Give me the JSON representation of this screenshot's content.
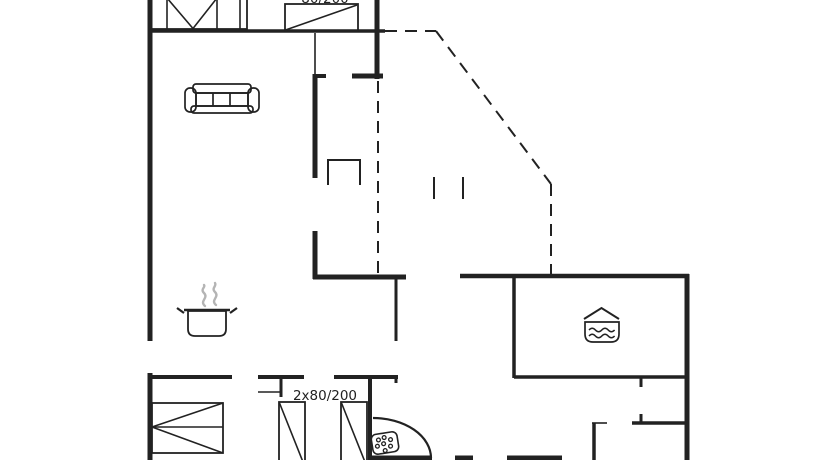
{
  "plan": {
    "width": 834,
    "height": 460,
    "line_color": "#222222",
    "steam_color": "#b4b4b4",
    "background": "#ffffff",
    "walls": [
      {
        "w": 5,
        "x1": 150,
        "y1": -2,
        "x2": 150,
        "y2": 341
      },
      {
        "w": 5,
        "x1": 150,
        "y1": 373,
        "x2": 150,
        "y2": 460
      },
      {
        "w": 5,
        "x1": 377,
        "y1": -2,
        "x2": 377,
        "y2": 79
      },
      {
        "w": 5,
        "x1": 352,
        "y1": 76,
        "x2": 383,
        "y2": 76
      },
      {
        "w": 4,
        "x1": 313,
        "y1": 76,
        "x2": 326,
        "y2": 76
      },
      {
        "w": 5,
        "x1": 315,
        "y1": 74,
        "x2": 315,
        "y2": 178
      },
      {
        "w": 5,
        "x1": 315,
        "y1": 231,
        "x2": 315,
        "y2": 279
      },
      {
        "w": 5,
        "x1": 313,
        "y1": 277,
        "x2": 406,
        "y2": 277
      },
      {
        "w": 4.5,
        "x1": 460,
        "y1": 276,
        "x2": 689,
        "y2": 276
      },
      {
        "w": 5,
        "x1": 687,
        "y1": 274,
        "x2": 687,
        "y2": 460
      },
      {
        "w": 3.5,
        "x1": 148,
        "y1": 31,
        "x2": 385,
        "y2": 31
      },
      {
        "w": 3,
        "x1": 396,
        "y1": 277,
        "x2": 396,
        "y2": 341
      },
      {
        "w": 3.5,
        "x1": 514,
        "y1": 276,
        "x2": 514,
        "y2": 378
      },
      {
        "w": 3.5,
        "x1": 514,
        "y1": 377,
        "x2": 687,
        "y2": 377
      },
      {
        "w": 3,
        "x1": 641,
        "y1": 377,
        "x2": 641,
        "y2": 387
      },
      {
        "w": 3,
        "x1": 641,
        "y1": 414,
        "x2": 641,
        "y2": 424
      },
      {
        "w": 3.5,
        "x1": 632,
        "y1": 423,
        "x2": 688,
        "y2": 423
      },
      {
        "w": 3.5,
        "x1": 594,
        "y1": 423,
        "x2": 594,
        "y2": 460
      },
      {
        "w": 4,
        "x1": 148,
        "y1": 377,
        "x2": 232,
        "y2": 377
      },
      {
        "w": 4,
        "x1": 258,
        "y1": 377,
        "x2": 304,
        "y2": 377
      },
      {
        "w": 4,
        "x1": 334,
        "y1": 377,
        "x2": 398,
        "y2": 377
      },
      {
        "w": 3,
        "x1": 281,
        "y1": 377,
        "x2": 281,
        "y2": 397
      },
      {
        "w": 3,
        "x1": 396,
        "y1": 377,
        "x2": 396,
        "y2": 383
      },
      {
        "w": 4,
        "x1": 370,
        "y1": 377,
        "x2": 370,
        "y2": 460
      },
      {
        "w": 5,
        "x1": 370,
        "y1": 458,
        "x2": 432,
        "y2": 458
      },
      {
        "w": 5,
        "x1": 455,
        "y1": 458,
        "x2": 473,
        "y2": 458
      },
      {
        "w": 5,
        "x1": 507,
        "y1": 458,
        "x2": 562,
        "y2": 458
      }
    ],
    "thin_lines": [
      {
        "name": "thin-wall-line",
        "w": 1.6,
        "x1": 315,
        "y1": 33,
        "x2": 315,
        "y2": 74
      },
      {
        "name": "thin-wall-line",
        "w": 1.6,
        "x1": 258,
        "y1": 392,
        "x2": 281,
        "y2": 392
      },
      {
        "name": "door-frame-line",
        "w": 1.6,
        "x1": 592,
        "y1": 423,
        "x2": 607,
        "y2": 423
      },
      {
        "name": "terrace-post-mark",
        "w": 2,
        "x1": 434,
        "y1": 177,
        "x2": 434,
        "y2": 199
      },
      {
        "name": "terrace-post-mark",
        "w": 2,
        "x1": 463,
        "y1": 177,
        "x2": 463,
        "y2": 199
      }
    ],
    "dashed_lines": [
      {
        "w": 2,
        "x1": 385,
        "y1": 31,
        "x2": 436,
        "y2": 31
      },
      {
        "w": 2,
        "x1": 436,
        "y1": 31,
        "x2": 551,
        "y2": 184
      },
      {
        "w": 2,
        "x1": 551,
        "y1": 184,
        "x2": 551,
        "y2": 276
      },
      {
        "w": 2,
        "x1": 378,
        "y1": 81,
        "x2": 378,
        "y2": 276
      }
    ],
    "texts": [
      {
        "name": "bunk-beds-size-label",
        "text": "2x80/200",
        "x": 325,
        "y": 400,
        "size": 13.5
      },
      {
        "name": "double-bed-size-label",
        "text": "180/200",
        "x": 207,
        "y": 470,
        "size": 13.5
      },
      {
        "name": "top-bed-size-label",
        "text": "80/200",
        "x": 325,
        "y": 3,
        "size": 13.5
      }
    ],
    "furniture": [
      {
        "name": "wardrobe-icon",
        "shapes": [
          {
            "t": "rect",
            "x": 150,
            "y": -4,
            "w": 97,
            "h": 33,
            "sw": 1.8
          },
          {
            "t": "line",
            "x1": 167,
            "y1": -2,
            "x2": 167,
            "y2": 29,
            "sw": 1.6
          },
          {
            "t": "line",
            "x1": 217,
            "y1": -2,
            "x2": 217,
            "y2": 29,
            "sw": 1.6
          },
          {
            "t": "line",
            "x1": 240,
            "y1": -2,
            "x2": 240,
            "y2": 29,
            "sw": 1.6
          },
          {
            "t": "poly",
            "pts": "167,-2 193,28.5 217,-2",
            "sw": 1.6
          }
        ]
      },
      {
        "name": "single-bed-icon",
        "shapes": [
          {
            "t": "rect",
            "x": 285,
            "y": 4,
            "w": 73,
            "h": 27,
            "sw": 1.8
          },
          {
            "t": "line",
            "x1": 285.5,
            "y1": 30,
            "x2": 357,
            "y2": 5,
            "sw": 1.6
          }
        ]
      },
      {
        "name": "sofa-icon",
        "shapes": [
          {
            "t": "rect",
            "x": 193,
            "y": 84,
            "w": 58,
            "h": 9,
            "rx": 3,
            "sw": 1.7
          },
          {
            "t": "rect",
            "x": 185,
            "y": 88,
            "w": 11,
            "h": 24,
            "rx": 5,
            "sw": 1.7
          },
          {
            "t": "rect",
            "x": 248,
            "y": 88,
            "w": 11,
            "h": 24,
            "rx": 5,
            "sw": 1.7
          },
          {
            "t": "rect",
            "x": 196,
            "y": 93,
            "w": 52,
            "h": 13,
            "sw": 1.7
          },
          {
            "t": "line",
            "x1": 213,
            "y1": 93,
            "x2": 213,
            "y2": 106,
            "sw": 1.7
          },
          {
            "t": "line",
            "x1": 230,
            "y1": 93,
            "x2": 230,
            "y2": 106,
            "sw": 1.7
          },
          {
            "t": "rect",
            "x": 191,
            "y": 106,
            "w": 62,
            "h": 7,
            "rx": 3,
            "sw": 1.7
          }
        ]
      },
      {
        "name": "fireplace-icon",
        "shapes": [
          {
            "t": "poly",
            "pts": "328,185 328,160 360,160 360,185",
            "sw": 2
          }
        ]
      },
      {
        "name": "cooking-pot-icon",
        "shapes": [
          {
            "t": "line",
            "x1": 184,
            "y1": 310,
            "x2": 230,
            "y2": 310,
            "sw": 2.4
          },
          {
            "t": "path",
            "d": "M188,311 h38 v18 q0,7 -7,7 h-24 q-7,0 -7,-7 z",
            "sw": 1.8
          },
          {
            "t": "line",
            "x1": 184,
            "y1": 313,
            "x2": 177,
            "y2": 308,
            "sw": 2.2
          },
          {
            "t": "line",
            "x1": 230,
            "y1": 313,
            "x2": 237,
            "y2": 308,
            "sw": 2.2
          },
          {
            "t": "path",
            "d": "M205,306 c-6,-5 4,-8 -1,-13 c-4,-4 2,-6 0,-8",
            "sw": 2.4,
            "stroke": "steam",
            "cap": "round"
          },
          {
            "t": "path",
            "d": "M216,305 c-6,-5 4,-8 -1,-13 c-4,-4 2,-6 0,-9",
            "sw": 2.4,
            "stroke": "steam",
            "cap": "round"
          }
        ]
      },
      {
        "name": "spa-tub-icon",
        "shapes": [
          {
            "t": "poly",
            "pts": "584,319 601.5,308 619,319",
            "sw": 2
          },
          {
            "t": "path",
            "d": "M585,322 h34 v12 q0,8 -8,8 h-18 q-8,0 -8,-8 z",
            "sw": 1.7
          },
          {
            "t": "path",
            "d": "M589,330 q3.2,-3.5 6.4,0 q3.2,3.5 6.4,0 q3.2,-3.5 6.4,0 q3.2,3.5 6.4,0",
            "sw": 1.5
          },
          {
            "t": "path",
            "d": "M589,336 q3.2,-3.5 6.4,0 q3.2,3.5 6.4,0 q3.2,-3.5 6.4,0 q3.2,3.5 6.4,0",
            "sw": 1.5
          }
        ]
      },
      {
        "name": "double-bed-icon",
        "shapes": [
          {
            "t": "rect",
            "x": 152,
            "y": 403,
            "w": 71,
            "h": 50,
            "sw": 1.8
          },
          {
            "t": "line",
            "x1": 152,
            "y1": 427,
            "x2": 223,
            "y2": 427,
            "sw": 1.6
          },
          {
            "t": "line",
            "x1": 223,
            "y1": 403,
            "x2": 152,
            "y2": 427,
            "sw": 1.6
          },
          {
            "t": "line",
            "x1": 152,
            "y1": 427,
            "x2": 223,
            "y2": 453,
            "sw": 1.6
          }
        ]
      },
      {
        "name": "single-bed-icon",
        "shapes": [
          {
            "t": "rect",
            "x": 279,
            "y": 402,
            "w": 26,
            "h": 60,
            "sw": 1.8
          },
          {
            "t": "line",
            "x1": 279.5,
            "y1": 403,
            "x2": 303,
            "y2": 462,
            "sw": 1.6
          }
        ]
      },
      {
        "name": "single-bed-icon",
        "shapes": [
          {
            "t": "rect",
            "x": 341,
            "y": 402,
            "w": 26,
            "h": 60,
            "sw": 1.8
          },
          {
            "t": "line",
            "x1": 341.5,
            "y1": 403,
            "x2": 365,
            "y2": 462,
            "sw": 1.6
          }
        ]
      },
      {
        "name": "shower-icon",
        "shapes": [
          {
            "t": "path",
            "d": "M373,418 A58,40 0 0 1 431,458",
            "sw": 2.2
          },
          {
            "t": "rect",
            "x": 372,
            "y": 433,
            "w": 26,
            "h": 20,
            "rx": 5,
            "sw": 1.6,
            "rot": "-9 385 443"
          },
          {
            "t": "circle",
            "cx": 379,
            "cy": 439,
            "r": 1.9,
            "sw": 1.3,
            "rot": "-9 385 443"
          },
          {
            "t": "circle",
            "cx": 385,
            "cy": 437.5,
            "r": 1.9,
            "sw": 1.3,
            "rot": "-9 385 443"
          },
          {
            "t": "circle",
            "cx": 391,
            "cy": 440.5,
            "r": 1.9,
            "sw": 1.3,
            "rot": "-9 385 443"
          },
          {
            "t": "circle",
            "cx": 377,
            "cy": 445,
            "r": 1.9,
            "sw": 1.3,
            "rot": "-9 385 443"
          },
          {
            "t": "circle",
            "cx": 383.5,
            "cy": 443.5,
            "r": 1.9,
            "sw": 1.3,
            "rot": "-9 385 443"
          },
          {
            "t": "circle",
            "cx": 390,
            "cy": 447,
            "r": 1.9,
            "sw": 1.3,
            "rot": "-9 385 443"
          },
          {
            "t": "circle",
            "cx": 384,
            "cy": 450.5,
            "r": 1.9,
            "sw": 1.3,
            "rot": "-9 385 443"
          }
        ]
      }
    ]
  }
}
